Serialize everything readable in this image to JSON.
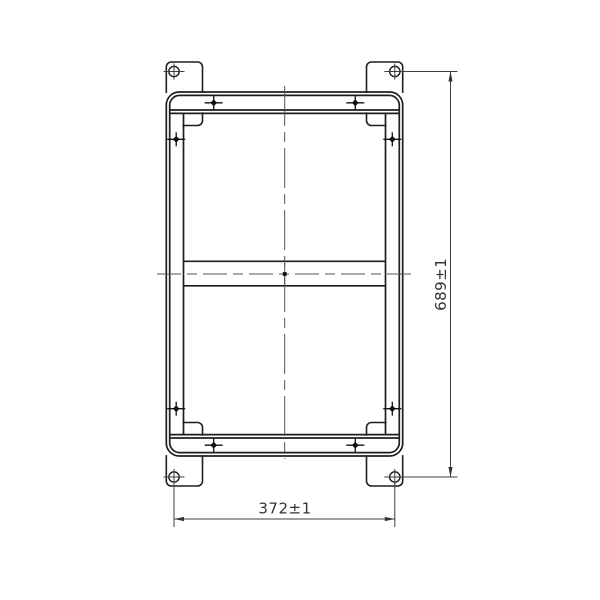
{
  "drawing": {
    "background_color": "#ffffff",
    "object_line_color": "#1e1e1e",
    "thin_line_color": "#3f3f3f",
    "centerline_color": "#555555",
    "dimensions": {
      "height": {
        "label": "689±1"
      },
      "width": {
        "label": "372±1"
      }
    }
  }
}
